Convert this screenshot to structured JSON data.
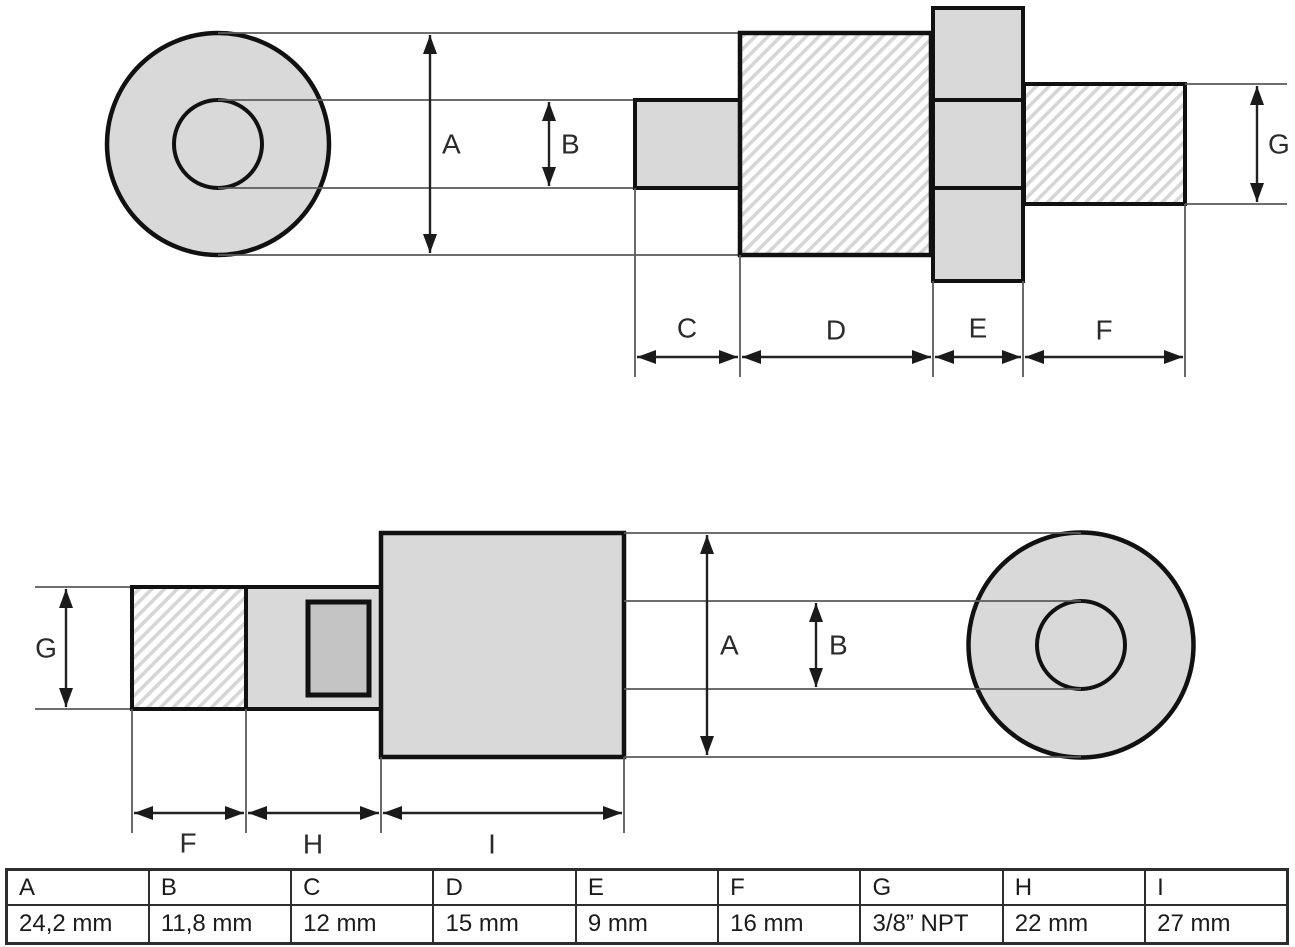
{
  "dim_labels": {
    "A": "A",
    "B": "B",
    "C": "C",
    "D": "D",
    "E": "E",
    "F": "F",
    "G": "G",
    "H": "H",
    "I": "I"
  },
  "table": {
    "headers": [
      "A",
      "B",
      "C",
      "D",
      "E",
      "F",
      "G",
      "H",
      "I"
    ],
    "values": [
      "24,2 mm",
      "11,8 mm",
      "12 mm",
      "15 mm",
      "9 mm",
      "16 mm",
      "3/8” NPT",
      "22 mm",
      "27 mm"
    ]
  },
  "colors": {
    "part_fill": "#d9d9d9",
    "slot_fill": "#c3c3c3",
    "outline": "#111111",
    "thin_line": "#5a5a5a",
    "hatch_line": "#d6d6d6",
    "background": "#ffffff"
  }
}
